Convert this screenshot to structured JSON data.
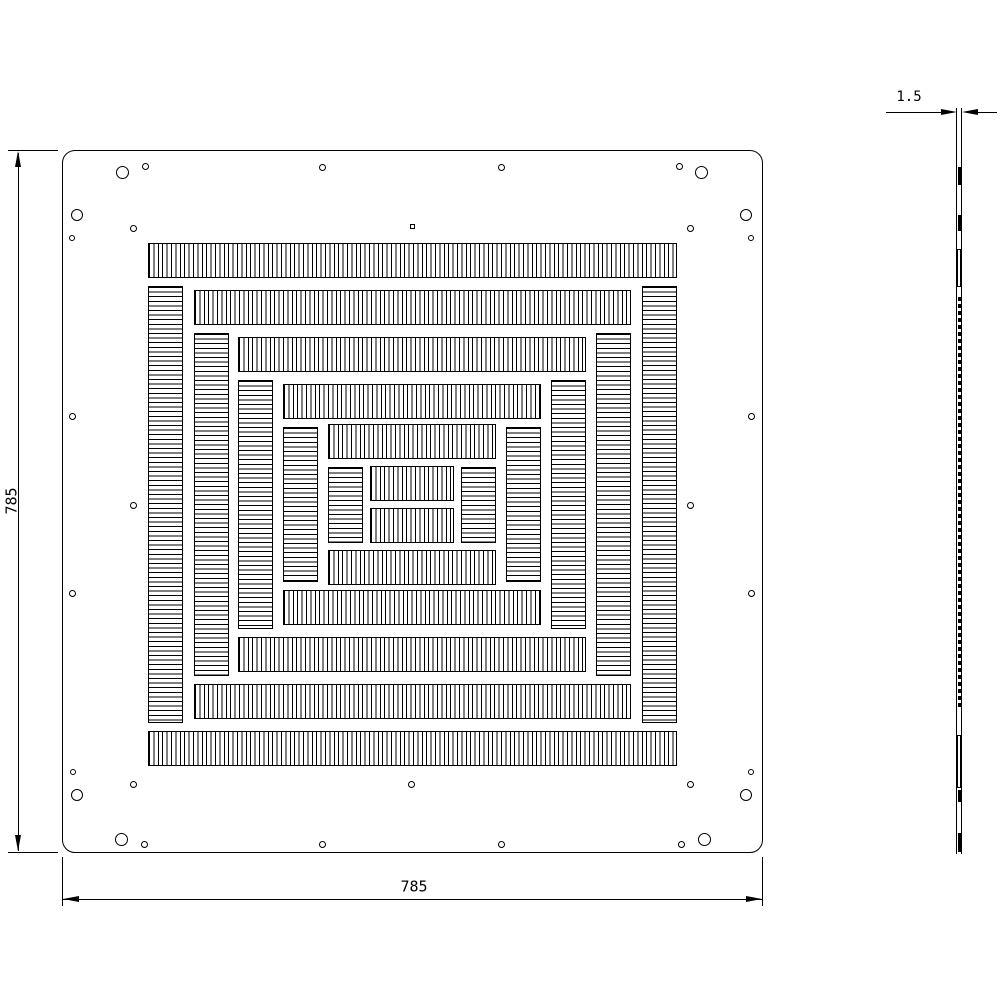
{
  "drawing": {
    "title": "slotted-plate-technical-drawing",
    "dimensions": {
      "height_label": "785",
      "width_label": "785",
      "thickness_label": "1.5"
    },
    "front": {
      "plate": {
        "x": 62,
        "y": 150,
        "w": 701,
        "h": 703,
        "corner_radius": 13
      },
      "bands": [
        [
          148,
          243,
          529,
          35,
          "v"
        ],
        [
          148,
          731,
          529,
          35,
          "v"
        ],
        [
          148,
          286,
          35,
          437,
          "h"
        ],
        [
          642,
          286,
          35,
          437,
          "h"
        ],
        [
          194,
          290,
          437,
          35,
          "v"
        ],
        [
          194,
          684,
          437,
          35,
          "v"
        ],
        [
          194,
          333,
          35,
          343,
          "h"
        ],
        [
          596,
          333,
          35,
          343,
          "h"
        ],
        [
          238,
          337,
          348,
          35,
          "v"
        ],
        [
          238,
          637,
          348,
          35,
          "v"
        ],
        [
          238,
          380,
          35,
          249,
          "h"
        ],
        [
          551,
          380,
          35,
          249,
          "h"
        ],
        [
          283,
          384,
          258,
          35,
          "v"
        ],
        [
          283,
          590,
          258,
          35,
          "v"
        ],
        [
          283,
          427,
          35,
          155,
          "h"
        ],
        [
          506,
          427,
          35,
          155,
          "h"
        ],
        [
          328,
          424,
          168,
          35,
          "v"
        ],
        [
          328,
          550,
          168,
          35,
          "v"
        ],
        [
          328,
          467,
          35,
          76,
          "h"
        ],
        [
          461,
          467,
          35,
          76,
          "h"
        ],
        [
          370,
          466,
          84,
          35,
          "v"
        ],
        [
          370,
          508,
          84,
          35,
          "v"
        ]
      ],
      "holes": [
        [
          122,
          172,
          13
        ],
        [
          145,
          166,
          7
        ],
        [
          77,
          215,
          12
        ],
        [
          133,
          228,
          7
        ],
        [
          72,
          238,
          6
        ],
        [
          322,
          167,
          7
        ],
        [
          501,
          167,
          7
        ],
        [
          701,
          172,
          13
        ],
        [
          679,
          166,
          7
        ],
        [
          746,
          215,
          12
        ],
        [
          690,
          228,
          7
        ],
        [
          751,
          238,
          6
        ],
        [
          72,
          416,
          7
        ],
        [
          133,
          505,
          7
        ],
        [
          72,
          593,
          7
        ],
        [
          751,
          416,
          7
        ],
        [
          690,
          505,
          7
        ],
        [
          751,
          593,
          7
        ],
        [
          73,
          772,
          6
        ],
        [
          133,
          784,
          7
        ],
        [
          77,
          795,
          12
        ],
        [
          121,
          839,
          13
        ],
        [
          144,
          844,
          7
        ],
        [
          322,
          844,
          7
        ],
        [
          411,
          784,
          7
        ],
        [
          501,
          844,
          7
        ],
        [
          751,
          772,
          6
        ],
        [
          690,
          784,
          7
        ],
        [
          746,
          795,
          12
        ],
        [
          704,
          839,
          13
        ],
        [
          681,
          844,
          7
        ]
      ],
      "square_hole": [
        412,
        226,
        5
      ]
    },
    "side": {
      "strip": {
        "x": 956,
        "y": 108,
        "w": 6,
        "h": 746
      },
      "marks": [
        [
          167,
          18,
          "thick"
        ],
        [
          215,
          16,
          "thick"
        ],
        [
          249,
          38,
          "thin"
        ],
        [
          735,
          53,
          "thin"
        ],
        [
          790,
          12,
          "thick"
        ],
        [
          833,
          19,
          "thick"
        ]
      ],
      "dense": {
        "from": 297,
        "to": 708,
        "period": 7,
        "len": 4
      }
    }
  }
}
